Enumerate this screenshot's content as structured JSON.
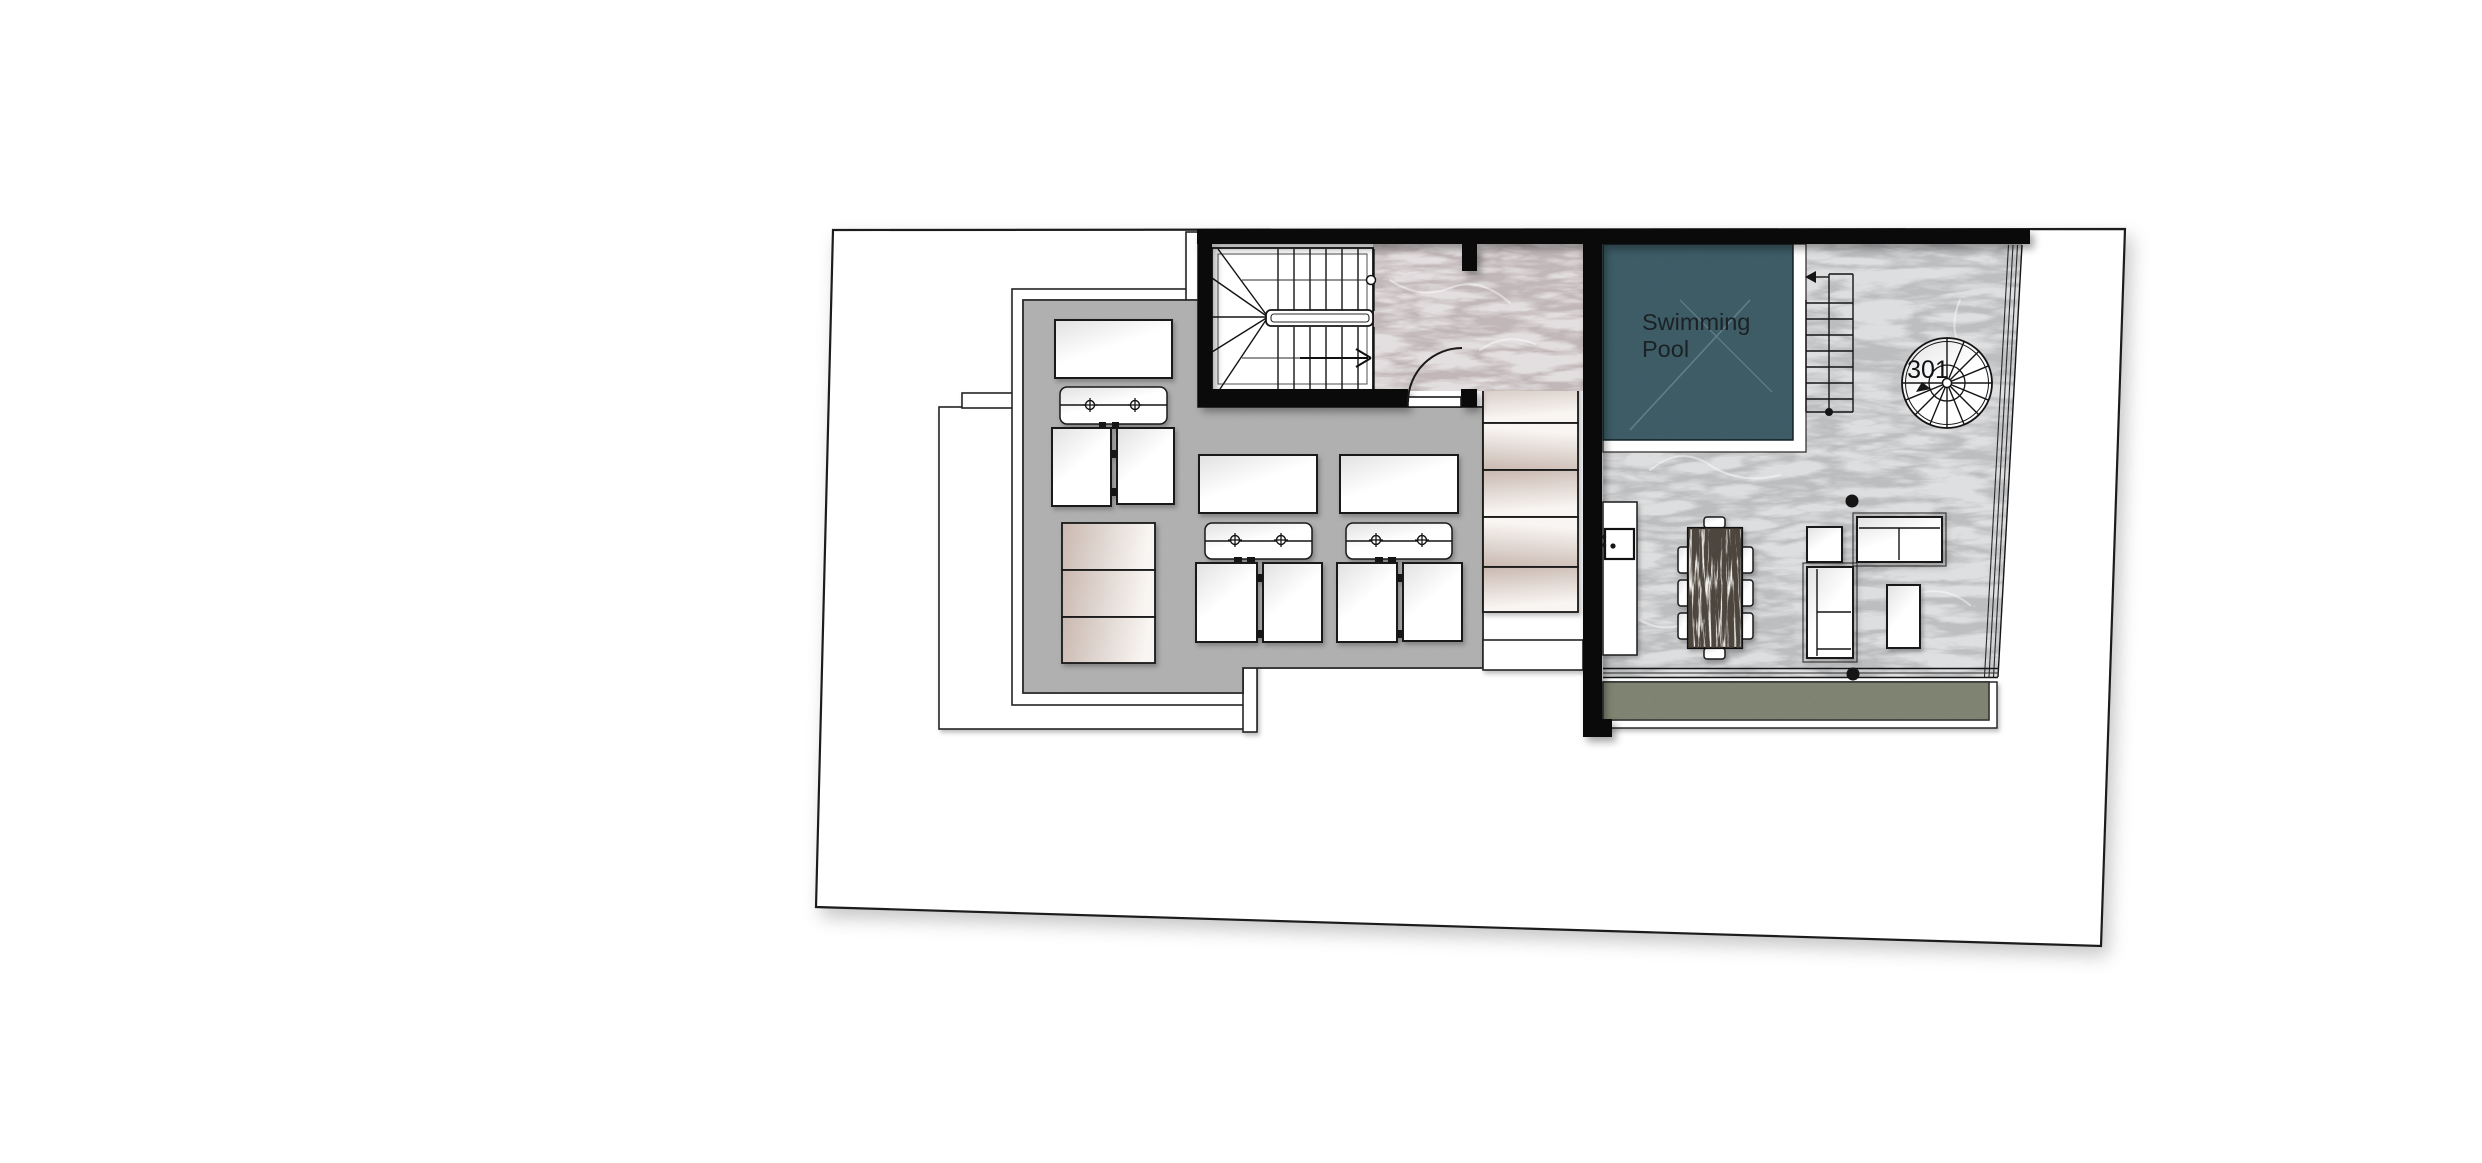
{
  "labels": {
    "pool_line1": "Swimming",
    "pool_line2": "Pool",
    "unit_number": "301"
  },
  "colors": {
    "outline": "#1c1c1c",
    "wall": "#0a0a0a",
    "pool_water": "#4f7784",
    "concrete_deck": "#c7c8c7",
    "terrace_marble": "#d3d4d6",
    "hall_marble": "#d8cdce",
    "grass": "#99a184",
    "beige_dark": "#c9b8b0",
    "beige_light": "#f8f5f2",
    "furniture_white": "#fdfdfd",
    "label_text": "#1b2124"
  }
}
